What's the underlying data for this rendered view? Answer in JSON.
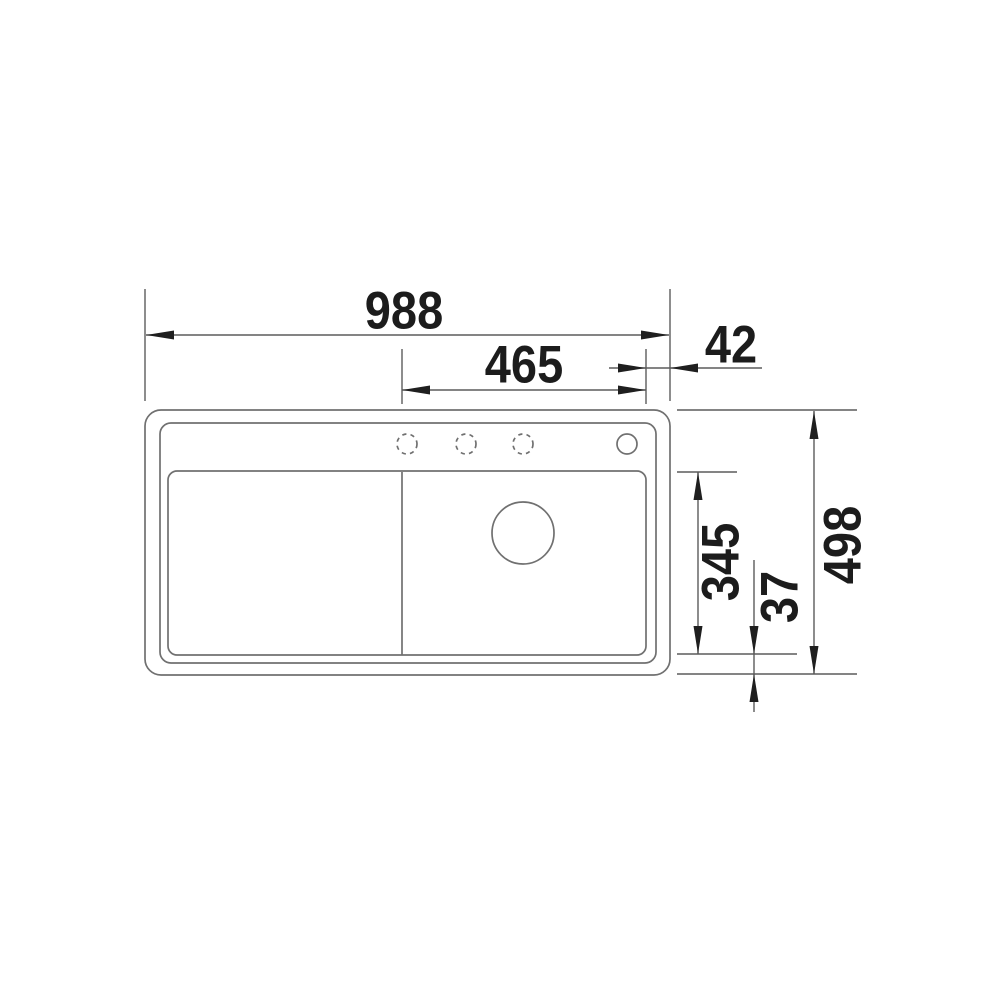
{
  "drawing": {
    "type": "technical-dimension-drawing",
    "subject": "kitchen sink with drainboard, top view",
    "colors": {
      "background": "#ffffff",
      "outline_line": "#707070",
      "dimension_line": "#5c5c5c",
      "arrow": "#1f1f1f",
      "text": "#1c1c1c"
    },
    "dimensions": {
      "overall_width": "988",
      "bowl_width": "465",
      "right_edge_offset": "42",
      "bowl_depth": "345",
      "bottom_edge_offset": "37",
      "overall_depth": "498"
    }
  }
}
